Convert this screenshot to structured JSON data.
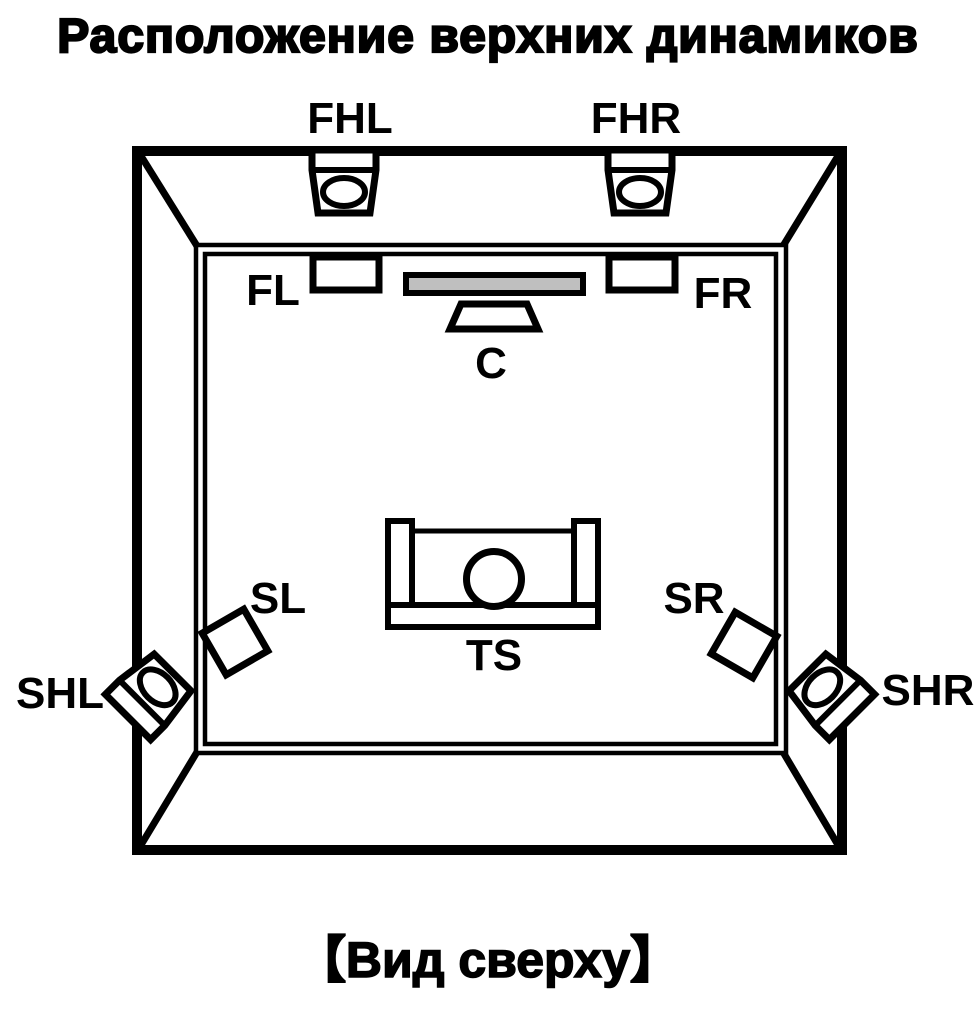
{
  "title": "Расположение верхних динамиков",
  "footer": {
    "view_label": "【Вид сверху】"
  },
  "colors": {
    "line": "#000000",
    "background": "#ffffff",
    "tv_screen_fill": "#bfbfbf"
  },
  "speakers": {
    "front_height_left": "FHL",
    "front_height_right": "FHR",
    "front_left": "FL",
    "front_right": "FR",
    "center": "C",
    "surround_left": "SL",
    "surround_right": "SR",
    "surround_height_left": "SHL",
    "surround_height_right": "SHR",
    "listening_seat": "TS"
  }
}
